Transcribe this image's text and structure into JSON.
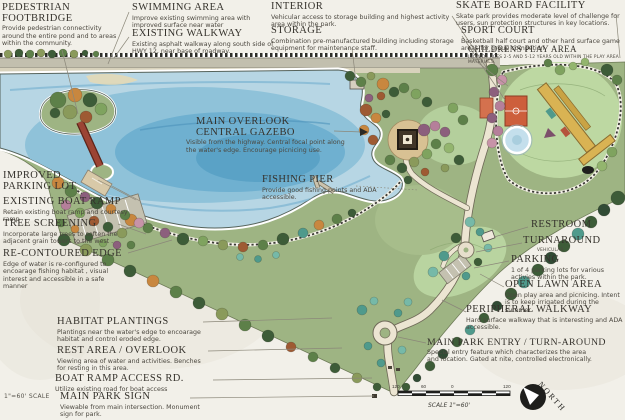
{
  "plan": {
    "scale_note": "1\"=60' SCALE",
    "scale_bar": {
      "labels": [
        "120",
        "60",
        "0",
        "120"
      ],
      "caption": "SCALE 1\"=60'"
    },
    "north_label": "NORTH"
  },
  "colors": {
    "paper": "#f2f0e9",
    "water_core": "#5aa2c6",
    "water_edge": "#b7d6e4",
    "land": "#9eb483",
    "lawn": "#bdd8a2",
    "path": "#ece5d2",
    "court_orange": "#cd5f3c",
    "play_yellow": "#d9b353",
    "bridge_red": "#9c4434"
  },
  "labels": {
    "pedestrian_footbridge": {
      "title": "PEDESTRIAN FOOTBRIDGE",
      "body": "Provide pedestrian connectivity around the entire pond and to areas within the community."
    },
    "swimming_area": {
      "title": "SWIMMING AREA",
      "body": "Improve existing swimming area with improved surface near water"
    },
    "existing_walkway": {
      "title": "EXISTING WALKWAY",
      "body": "Existing asphalt walkway along south side of HWY 12, near base of roadway."
    },
    "interior": {
      "title": "INTERIOR",
      "body": "Vehicular access to storage building and highest activity area within the park."
    },
    "storage": {
      "title": "STORAGE",
      "body": "Combination pre-manufactured building including storage equipment for maintenance staff."
    },
    "skate_board_facility": {
      "title": "SKATE BOARD FACILITY",
      "body": "Skate park provides moderate level of challenge for users, sun protection structures in key locations."
    },
    "sport_court": {
      "title": "SPORT COURT",
      "body": "Basketball half court and other hard surface game areas for group competion."
    },
    "childrens_play_area": {
      "title": "CHILDRENS PLAY AREA",
      "body": "INCLUDE AGES 2-5 AND 5-12 YEARS OLD WITHIN THE PLAY AREA MATERIALS."
    },
    "main_overlook": {
      "title": "MAIN OVERLOOK CENTRAL GAZEBO",
      "body": "Visible from the highway. Central focal point along the water's edge. Encourage picnicing use."
    },
    "fishing_pier": {
      "title": "FISHING PIER",
      "body": "Provide good fishing points and ADA accessible."
    },
    "improved_parking_lot": {
      "title": "IMPROVED PARKING LOT",
      "body": ""
    },
    "existing_boat_ramp": {
      "title": "EXISTING BOAT RAMP",
      "body": "Retain existing boat ramp and courtesy ramp"
    },
    "tree_screening": {
      "title": "TREE SCREENING",
      "body": "Incorporate large trees to soften the adjacent grain towers to the west ."
    },
    "re_contoured_edge": {
      "title": "RE-CONTOURED EDGE",
      "body": "Edge of water is re-configured to encoarage fishing habitat , visual interest and accessible in a safe manner"
    },
    "habitat_plantings": {
      "title": "HABITAT PLANTINGS",
      "body": "Plantings near the water's edge to encoarage habitat and control eroded edge."
    },
    "rest_area_overlook": {
      "title": "REST AREA / OVERLOOK",
      "body": "Viewing area of water and activities. Benches for resting in this area."
    },
    "boat_ramp_access_rd": {
      "title": "BOAT RAMP ACCESS RD.",
      "body": "Utilize existing road for boat access"
    },
    "main_park_sign": {
      "title": "MAIN PARK SIGN",
      "body": "Viewable from main intersection. Monument sign for park."
    },
    "restroom": {
      "title": "RESTROOM",
      "body": ""
    },
    "turnaround": {
      "title": "TURNAROUND",
      "body": "VEHICULAR"
    },
    "parking": {
      "title": "PARKING",
      "body": "1 of 4 parking lots for various activies within the park."
    },
    "open_lawn_area": {
      "title": "OPEN LAWN AREA",
      "body": "Open play area and picnicing. Intent is to keep irrigated during the summer"
    },
    "peripheral_walkway": {
      "title": "PERIPHERAL WALKWAY",
      "body": "Hard surface walkway that is interesting and ADA accessible."
    },
    "main_park_entry": {
      "title": "MAIN PARK ENTRY / TURN-AROUND",
      "body": "Special entry feature which characterizes the area and location. Gated at nite, controlled electronically."
    }
  }
}
